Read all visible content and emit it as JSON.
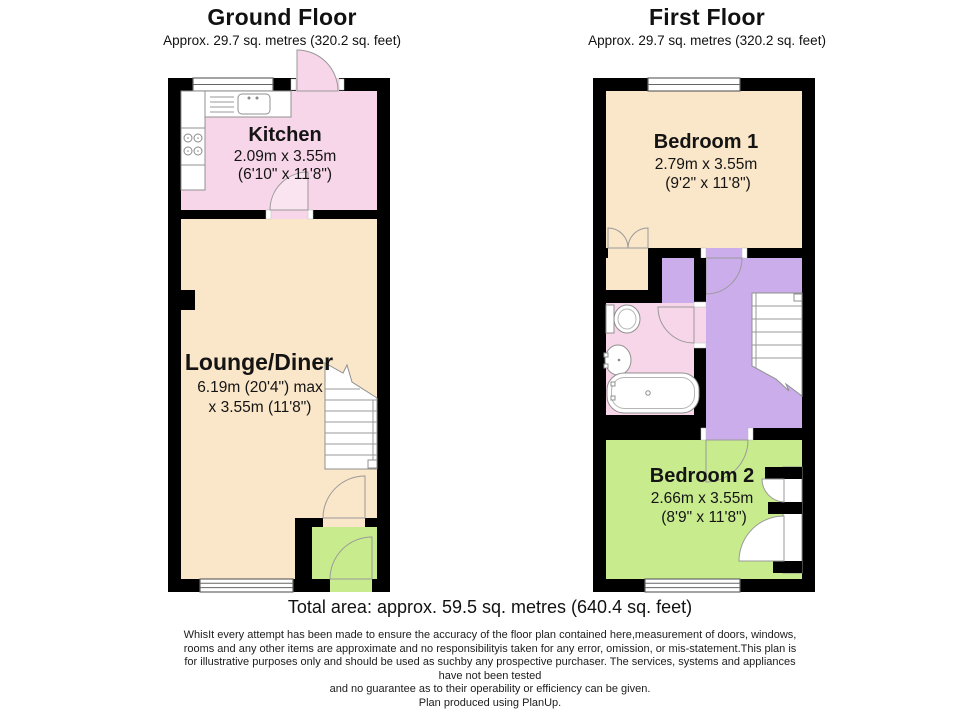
{
  "ground": {
    "title": "Ground Floor",
    "subtitle": "Approx. 29.7 sq. metres (320.2 sq. feet)",
    "rooms": {
      "kitchen": {
        "name": "Kitchen",
        "dims_metric": "2.09m x 3.55m",
        "dims_imperial": "(6'10\" x 11'8\")"
      },
      "lounge": {
        "name": "Lounge/Diner",
        "dims_line1": "6.19m (20'4\") max",
        "dims_line2": "x 3.55m (11'8\")"
      }
    }
  },
  "first": {
    "title": "First Floor",
    "subtitle": "Approx. 29.7 sq. metres (320.2 sq. feet)",
    "rooms": {
      "bedroom1": {
        "name": "Bedroom 1",
        "dims_metric": "2.79m x 3.55m",
        "dims_imperial": "(9'2\" x 11'8\")"
      },
      "bedroom2": {
        "name": "Bedroom 2",
        "dims_metric": "2.66m x 3.55m",
        "dims_imperial": "(8'9\" x 11'8\")"
      }
    }
  },
  "footer": {
    "total_area": "Total area: approx. 59.5 sq. metres (640.4 sq. feet)",
    "disclaimer_lines": [
      "WhisIt every attempt has been made to ensure the accuracy of the floor plan contained here,measurement of doors, windows,",
      "rooms and any other items are approximate and no responsibilityis taken for any error, omission, or mis-statement.This plan is",
      "for illustrative purposes only and should be used as suchby any prospective purchaser. The services, systems and appliances",
      "have not been tested",
      "and no guarantee as to their operability or efficiency can be given."
    ],
    "credit": "Plan produced using PlanUp."
  },
  "colors": {
    "wall": "#000000",
    "cream": "#fae6c8",
    "pink": "#f8d6e9",
    "green": "#c8eb8e",
    "purple": "#cbadeb",
    "fixturestroke": "#909090",
    "doorstroke": "#9a9a9a",
    "text": "#111111"
  }
}
